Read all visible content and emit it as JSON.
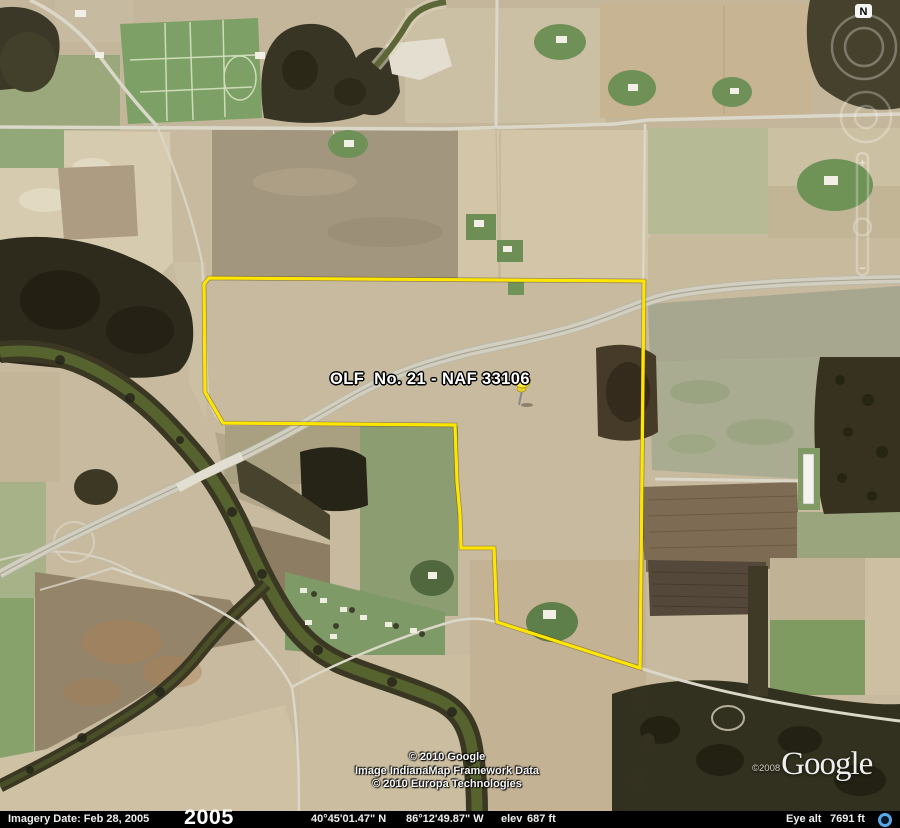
{
  "placemark": {
    "label": "OLF  No. 21 - NAF 33106"
  },
  "nav": {
    "north_label": "N",
    "zoom_in": "+",
    "zoom_out": "−"
  },
  "map_credits": {
    "line1": "© 2010 Google",
    "line2": "Image IndianaMap Framework Data",
    "line3": "© 2010 Europa Technologies"
  },
  "watermark": {
    "copyright_year": "©2008",
    "brand": "Google"
  },
  "status_bar": {
    "imagery_date": "Imagery Date: Feb 28, 2005",
    "timeline_year": "2005",
    "latitude": "40°45'01.47\" N",
    "longitude": "86°12'49.87\" W",
    "elev_label": "elev",
    "elev_value": "687 ft",
    "eye_alt_label": "Eye alt",
    "eye_alt_value": "7691 ft"
  },
  "colors": {
    "boundary_yellow": "#ffe600",
    "pushpin_yellow": "#ffe94a",
    "river_olive": "#57632f",
    "streaming_indicator": "#5aa7e8",
    "status_bar_bg": "#000000"
  }
}
